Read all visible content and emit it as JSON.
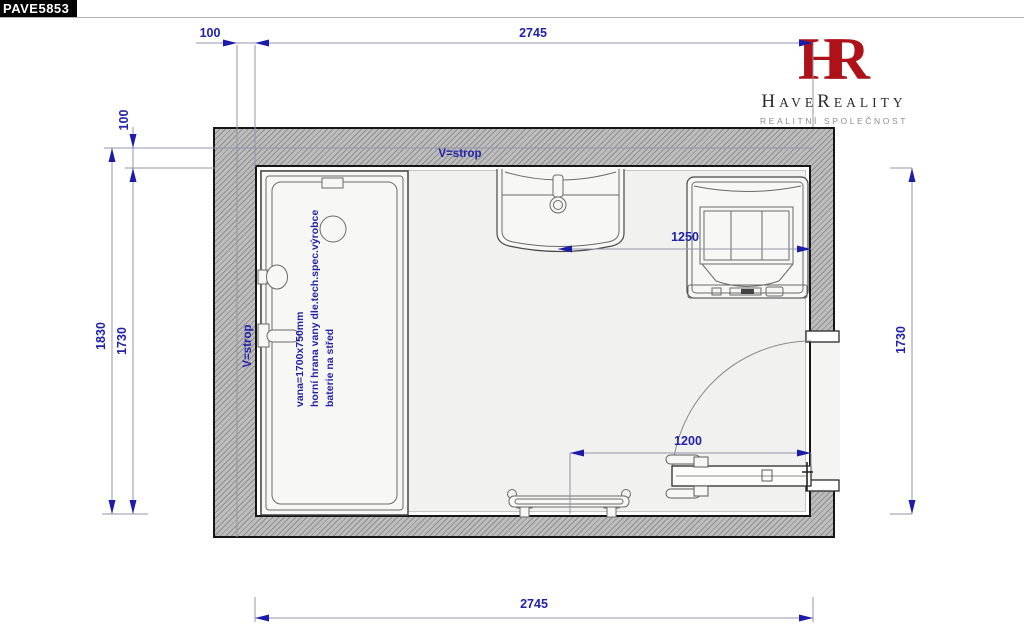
{
  "badge": {
    "code": "PAVE5853"
  },
  "logo": {
    "monogram_h": "H",
    "monogram_r": "R",
    "brand_h": "H",
    "brand_ave": "AVE",
    "brand_r": "R",
    "brand_eality": "EALITY",
    "subtitle": "REALITNÍ SPOLEČNOST"
  },
  "plan": {
    "ceiling_label_top": "V=strop",
    "ceiling_label_left": "V=strop",
    "bathtub_note": {
      "line1": "vana=1700x750mm",
      "line2": "horní hrana vany dle.tech.spec.výrobce",
      "line3": "baterie na střed"
    },
    "dimensions": {
      "top_offset": "100",
      "top_width": "2745",
      "left_offset": "100",
      "left_total": "1830",
      "left_inner": "1730",
      "right_inner": "1730",
      "bottom_width": "2745",
      "sink_to_wall": "1250",
      "radiator_to_wall": "1200"
    }
  },
  "colors": {
    "dimension_blue": "#2121a9",
    "logo_red": "#ae1117",
    "wall_fill": "#bdbdbd",
    "wall_hatch_line": "#8f8f8f",
    "floor": "#f1f1ef"
  }
}
